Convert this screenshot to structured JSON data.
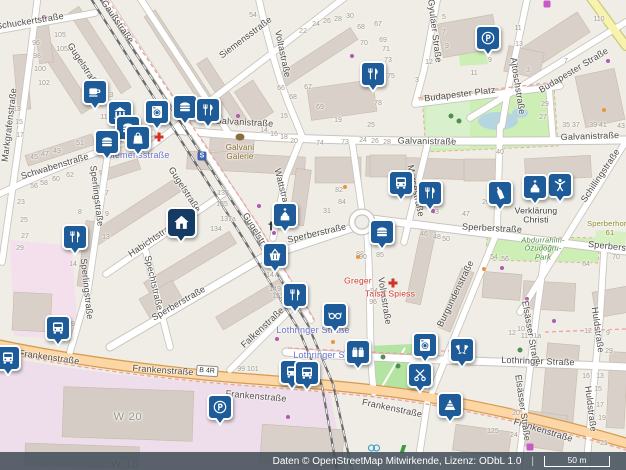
{
  "map": {
    "attribution": "Daten © OpenStreetMap Mitwirkende, Lizenz: ODbL 1.0",
    "scale_label": "50 m",
    "road_badge": "B 4R",
    "station_icon": "S",
    "colors": {
      "marker_blue": "#1d5c99",
      "marker_dark_navy": "#153a63",
      "primary_road": "#fcd6a4",
      "park_green": "#cdeeb5",
      "industrial_pink": "#eeddeb",
      "transit_label_blue": "#6b74c8",
      "poi_red": "#d03b2f"
    },
    "street_labels": [
      [
        "Schuckertstraße",
        30,
        22,
        -9
      ],
      [
        "Gaußstraße",
        117,
        22,
        55
      ],
      [
        "Gugelstraße",
        83,
        66,
        57
      ],
      [
        "Markgrafenstraße",
        10,
        125,
        -83
      ],
      [
        "Schwabenstraße",
        55,
        167,
        -17
      ],
      [
        "Siemensstraße",
        246,
        38,
        -37
      ],
      [
        "Voltastraße",
        282,
        54,
        78
      ],
      [
        "Gyulaer Straße",
        434,
        31,
        83
      ],
      [
        "Ajtoschstraße",
        517,
        86,
        81
      ],
      [
        "Budapester Platz",
        460,
        95,
        -7
      ],
      [
        "Budapester Straße",
        574,
        71,
        -31
      ],
      [
        "Galvanistraße",
        244,
        123,
        3
      ],
      [
        "Galvanistraße",
        427,
        142,
        1
      ],
      [
        "Galvanistraße",
        590,
        137,
        -2
      ],
      [
        "Schillingstraße",
        601,
        176,
        -56
      ],
      [
        "Gugelstraße",
        184,
        190,
        57
      ],
      [
        "Wattstraße",
        282,
        191,
        76
      ],
      [
        "Morsestraße",
        415,
        191,
        78
      ],
      [
        "Sperlingstraße",
        96,
        196,
        83
      ],
      [
        "Habichtstraße",
        154,
        239,
        -34
      ],
      [
        "Gugelstraße",
        258,
        236,
        58
      ],
      [
        "Sperberstraße",
        317,
        234,
        -13
      ],
      [
        "Sperberstraße",
        492,
        229,
        3
      ],
      [
        "Sperberstraße",
        618,
        248,
        6
      ],
      [
        "Burgundenstraße",
        456,
        294,
        -64
      ],
      [
        "Spechtstraße",
        153,
        283,
        77
      ],
      [
        "Sperlingstraße",
        86,
        289,
        84
      ],
      [
        "Sperberstraße",
        179,
        304,
        -30
      ],
      [
        "Voltastraße",
        384,
        301,
        81
      ],
      [
        "Elsässer Straße",
        530,
        334,
        80
      ],
      [
        "Huldstraße",
        597,
        330,
        82
      ],
      [
        "Falkenstraße",
        263,
        328,
        -43
      ],
      [
        "Lothringer Straße",
        538,
        362,
        2
      ],
      [
        "Frankenstraße",
        49,
        358,
        8
      ],
      [
        "Frankenstraße",
        163,
        371,
        4
      ],
      [
        "Frankenstraße",
        256,
        397,
        5
      ],
      [
        "Frankenstraße",
        392,
        409,
        12
      ],
      [
        "Frankenstraße",
        543,
        431,
        17
      ],
      [
        "Elsässer Straße",
        522,
        408,
        82
      ],
      [
        "Huldstraße",
        590,
        409,
        83
      ]
    ],
    "transit_labels": [
      [
        "Siemensstraße",
        138,
        156
      ],
      [
        "Lothringer Straße",
        313,
        331
      ],
      [
        "Lothringer Straße",
        330,
        356
      ]
    ],
    "poi_labels": [
      {
        "t": "Galvani\nGalerie",
        "x": 240,
        "y": 153,
        "c": "brown"
      },
      {
        "t": "Verklärung\nChristi",
        "x": 536,
        "y": 216,
        "c": "dk"
      },
      {
        "t": "Greger",
        "x": 358,
        "y": 281,
        "c": "red"
      },
      {
        "t": "Taisa Spiess",
        "x": 390,
        "y": 294,
        "c": "red"
      },
      {
        "t": "Abdurrahim-\nÖzudoğru-\nPark",
        "x": 543,
        "y": 249,
        "c": "grn"
      },
      {
        "t": "Sperberhort",
        "x": 608,
        "y": 224,
        "c": "olv"
      },
      {
        "t": "61",
        "x": 610,
        "y": 233,
        "c": "olv"
      },
      {
        "t": "W 20",
        "x": 128,
        "y": 417,
        "c": "big"
      },
      {
        "t": "W 18",
        "x": 125,
        "y": 464,
        "c": "big"
      }
    ],
    "house_numbers": [
      [
        "96",
        36,
        44
      ],
      [
        "98",
        37,
        57
      ],
      [
        "100",
        40,
        70
      ],
      [
        "102",
        44,
        84
      ],
      [
        "105",
        60,
        36
      ],
      [
        "105a",
        64,
        50
      ],
      [
        "113",
        108,
        96
      ],
      [
        "112",
        106,
        118
      ],
      [
        "13",
        17,
        110
      ],
      [
        "15",
        19,
        123
      ],
      [
        "17",
        20,
        136
      ],
      [
        "51",
        80,
        144
      ],
      [
        "49",
        57,
        152
      ],
      [
        "47",
        45,
        155
      ],
      [
        "45",
        34,
        158
      ],
      [
        "54",
        253,
        16
      ],
      [
        "22",
        303,
        32
      ],
      [
        "24",
        316,
        25
      ],
      [
        "26",
        327,
        22
      ],
      [
        "28",
        338,
        20
      ],
      [
        "30",
        350,
        17
      ],
      [
        "68",
        361,
        28
      ],
      [
        "67",
        378,
        25
      ],
      [
        "70",
        364,
        44
      ],
      [
        "69",
        383,
        41
      ],
      [
        "71",
        386,
        50
      ],
      [
        "73",
        388,
        61
      ],
      [
        "75",
        391,
        77
      ],
      [
        "3",
        417,
        81
      ],
      [
        "66",
        281,
        89
      ],
      [
        "67",
        308,
        88
      ],
      [
        "68",
        293,
        98
      ],
      [
        "69",
        320,
        108
      ],
      [
        "78",
        378,
        104
      ],
      [
        "19",
        338,
        121
      ],
      [
        "25",
        371,
        126
      ],
      [
        "15",
        284,
        117
      ],
      [
        "14",
        264,
        131
      ],
      [
        "16",
        274,
        135
      ],
      [
        "18",
        284,
        138
      ],
      [
        "20",
        294,
        142
      ],
      [
        "74",
        320,
        144
      ],
      [
        "73",
        345,
        143
      ],
      [
        "24",
        363,
        141
      ],
      [
        "26",
        375,
        142
      ],
      [
        "28",
        387,
        143
      ],
      [
        "5",
        444,
        18
      ],
      [
        "7",
        444,
        33
      ],
      [
        "9",
        447,
        47
      ],
      [
        "12",
        429,
        63
      ],
      [
        "9",
        490,
        61
      ],
      [
        "11",
        518,
        29
      ],
      [
        "13",
        519,
        45
      ],
      [
        "7",
        566,
        62
      ],
      [
        "3",
        528,
        71
      ],
      [
        "11",
        474,
        74
      ],
      [
        "29",
        545,
        105
      ],
      [
        "27",
        543,
        118
      ],
      [
        "35 37",
        571,
        126
      ],
      [
        "39 41",
        598,
        126
      ],
      [
        "43",
        621,
        127
      ],
      [
        "34",
        450,
        142
      ],
      [
        "40",
        500,
        153
      ],
      [
        "110",
        599,
        20
      ],
      [
        "62",
        70,
        176
      ],
      [
        "60",
        56,
        180
      ],
      [
        "58",
        44,
        184
      ],
      [
        "56",
        34,
        187
      ],
      [
        "23",
        21,
        203
      ],
      [
        "25",
        24,
        221
      ],
      [
        "27",
        25,
        237
      ],
      [
        "29",
        20,
        249
      ],
      [
        "8",
        80,
        213
      ],
      [
        "7",
        107,
        194
      ],
      [
        "9",
        107,
        215
      ],
      [
        "13",
        106,
        238
      ],
      [
        "133",
        223,
        194
      ],
      [
        "135",
        222,
        205
      ],
      [
        "134",
        216,
        230
      ],
      [
        "137a",
        228,
        220
      ],
      [
        "31",
        327,
        212
      ],
      [
        "82",
        339,
        191
      ],
      [
        "84",
        342,
        203
      ],
      [
        "88",
        360,
        255
      ],
      [
        "90",
        363,
        258
      ],
      [
        "85",
        380,
        256
      ],
      [
        "145",
        268,
        265
      ],
      [
        "147",
        272,
        276
      ],
      [
        "149",
        275,
        290
      ],
      [
        "151",
        278,
        297
      ],
      [
        "94",
        374,
        292
      ],
      [
        "96",
        373,
        303
      ],
      [
        "20",
        486,
        203
      ],
      [
        "43",
        435,
        213
      ],
      [
        "47",
        466,
        215
      ],
      [
        "46",
        424,
        235
      ],
      [
        "48",
        437,
        238
      ],
      [
        "50",
        446,
        240
      ],
      [
        "54",
        494,
        258
      ],
      [
        "56",
        505,
        260
      ],
      [
        "64",
        586,
        265
      ],
      [
        "70",
        616,
        258
      ],
      [
        "99 101",
        248,
        370
      ],
      [
        "39",
        71,
        325
      ],
      [
        "10",
        521,
        330
      ],
      [
        "12",
        512,
        334
      ],
      [
        "11 11a",
        531,
        337
      ],
      [
        "12",
        588,
        332
      ],
      [
        "9",
        608,
        334
      ],
      [
        "29",
        609,
        352
      ],
      [
        "16",
        586,
        377
      ],
      [
        "13",
        600,
        377
      ],
      [
        "15",
        598,
        390
      ],
      [
        "17",
        600,
        406
      ],
      [
        "19",
        602,
        419
      ],
      [
        "21",
        604,
        444
      ],
      [
        "20",
        516,
        414
      ],
      [
        "24",
        514,
        436
      ],
      [
        "125",
        493,
        432
      ],
      [
        "14",
        73,
        265
      ]
    ],
    "markers": [
      {
        "icon": "cafe",
        "x": 95,
        "y": 92
      },
      {
        "icon": "museum",
        "x": 120,
        "y": 113
      },
      {
        "icon": "burger",
        "x": 185,
        "y": 107
      },
      {
        "icon": "restaurant",
        "x": 208,
        "y": 110
      },
      {
        "icon": "laundry",
        "x": 157,
        "y": 112
      },
      {
        "icon": "burger",
        "x": 128,
        "y": 128
      },
      {
        "icon": "kiosk",
        "x": 138,
        "y": 138
      },
      {
        "icon": "burger",
        "x": 107,
        "y": 142
      },
      {
        "icon": "restaurant",
        "x": 373,
        "y": 74
      },
      {
        "icon": "parking",
        "x": 488,
        "y": 38
      },
      {
        "icon": "bus",
        "x": 401,
        "y": 183
      },
      {
        "icon": "fitness",
        "x": 560,
        "y": 185
      },
      {
        "icon": "church",
        "x": 535,
        "y": 187
      },
      {
        "icon": "restaurant",
        "x": 430,
        "y": 193
      },
      {
        "icon": "wine",
        "x": 500,
        "y": 193
      },
      {
        "icon": "church",
        "x": 285,
        "y": 215
      },
      {
        "icon": "home",
        "x": 181,
        "y": 222,
        "v": "dark"
      },
      {
        "icon": "burger",
        "x": 382,
        "y": 232
      },
      {
        "icon": "restaurant",
        "x": 75,
        "y": 237
      },
      {
        "icon": "basket",
        "x": 275,
        "y": 255
      },
      {
        "icon": "restaurant",
        "x": 295,
        "y": 295
      },
      {
        "icon": "glasses",
        "x": 335,
        "y": 315
      },
      {
        "icon": "bus",
        "x": 58,
        "y": 328
      },
      {
        "icon": "laundry",
        "x": 425,
        "y": 345
      },
      {
        "icon": "bar",
        "x": 462,
        "y": 350
      },
      {
        "icon": "luggage",
        "x": 358,
        "y": 352
      },
      {
        "icon": "bus",
        "x": 8,
        "y": 358
      },
      {
        "icon": "bus",
        "x": 292,
        "y": 372
      },
      {
        "icon": "bus",
        "x": 307,
        "y": 373
      },
      {
        "icon": "scissors",
        "x": 420,
        "y": 375
      },
      {
        "icon": "cake",
        "x": 450,
        "y": 405
      },
      {
        "icon": "parking",
        "x": 220,
        "y": 407
      }
    ],
    "map_symbols": [
      {
        "k": "pharmacy-cross",
        "x": 159,
        "y": 137
      },
      {
        "k": "pharmacy-cross",
        "x": 393,
        "y": 283
      },
      {
        "k": "church-cross",
        "x": 271,
        "y": 226
      },
      {
        "k": "church-cross",
        "x": 535,
        "y": 201
      },
      {
        "k": "palette",
        "x": 240,
        "y": 137
      },
      {
        "k": "s-badge",
        "x": 202,
        "y": 156
      },
      {
        "k": "bike",
        "x": 374,
        "y": 448
      },
      {
        "k": "runner",
        "x": 403,
        "y": 449
      },
      {
        "k": "locker",
        "x": 530,
        "y": 447
      },
      {
        "k": "locker",
        "x": 547,
        "y": 4
      },
      {
        "k": "tree",
        "x": 451,
        "y": 116
      },
      {
        "k": "tree",
        "x": 459,
        "y": 121
      },
      {
        "k": "tree",
        "x": 383,
        "y": 357
      },
      {
        "k": "tree",
        "x": 398,
        "y": 366
      },
      {
        "k": "tree",
        "x": 520,
        "y": 350
      }
    ],
    "dots": [
      {
        "x": 44,
        "y": 17,
        "c": "p"
      },
      {
        "x": 238,
        "y": 116,
        "c": "p"
      },
      {
        "x": 352,
        "y": 56,
        "c": "p"
      },
      {
        "x": 259,
        "y": 206,
        "c": "p"
      },
      {
        "x": 433,
        "y": 211,
        "c": "p"
      },
      {
        "x": 527,
        "y": 299,
        "c": "p"
      },
      {
        "x": 277,
        "y": 339,
        "c": "p"
      },
      {
        "x": 288,
        "y": 417,
        "c": "p"
      },
      {
        "x": 554,
        "y": 321,
        "c": "p"
      },
      {
        "x": 274,
        "y": 233,
        "c": "p"
      },
      {
        "x": 502,
        "y": 268,
        "c": "p"
      },
      {
        "x": 608,
        "y": 61,
        "c": "p"
      },
      {
        "x": 67,
        "y": 230,
        "c": "o"
      },
      {
        "x": 140,
        "y": 150,
        "c": "o"
      },
      {
        "x": 345,
        "y": 187,
        "c": "o"
      },
      {
        "x": 484,
        "y": 269,
        "c": "o"
      },
      {
        "x": 333,
        "y": 342,
        "c": "o"
      },
      {
        "x": 505,
        "y": 196,
        "c": "o"
      },
      {
        "x": 358,
        "y": 257,
        "c": "o"
      },
      {
        "x": 604,
        "y": 110,
        "c": "o"
      }
    ]
  }
}
